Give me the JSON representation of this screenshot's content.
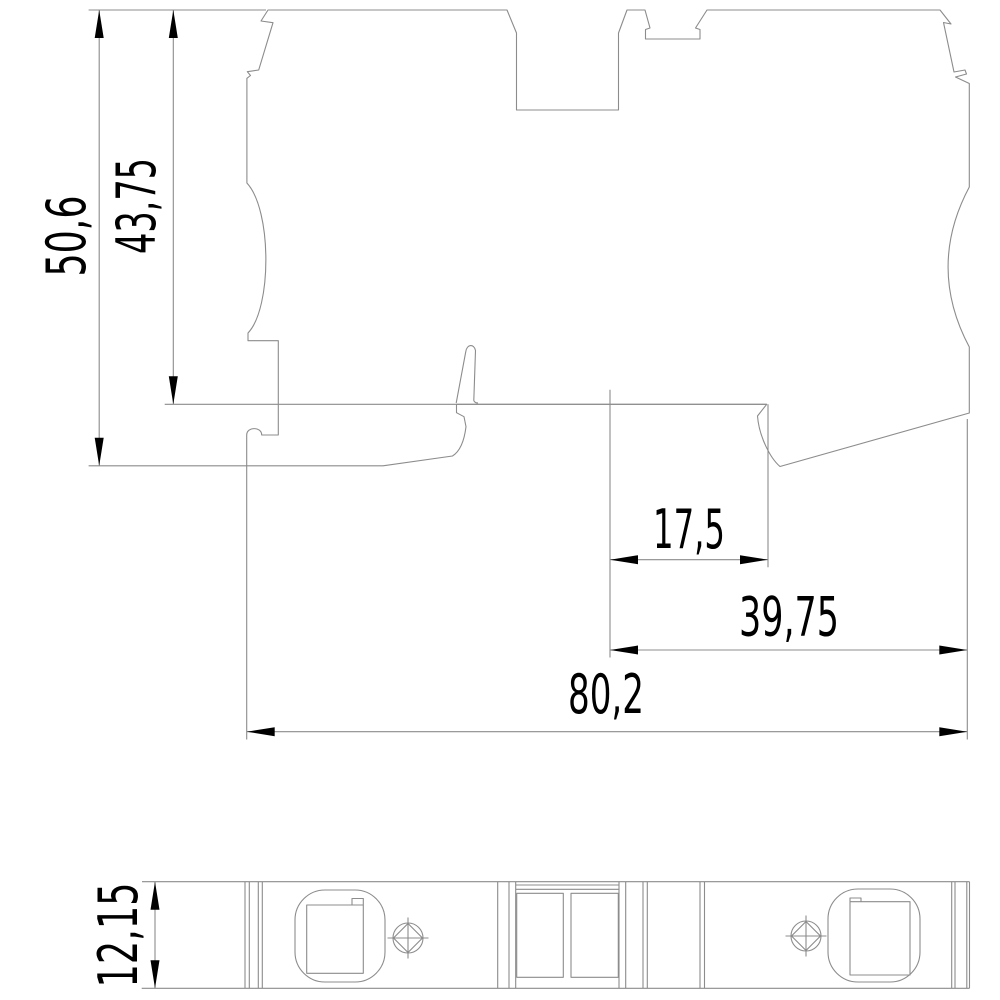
{
  "drawing": {
    "kind": "technical-dimension-drawing",
    "background_color": "#ffffff",
    "line_color": "#8c8c8c",
    "annotation_color": "#000000",
    "dimensions": {
      "overall_height": "50,6",
      "upper_height": "43,75",
      "pitch_offset": "17,5",
      "right_section_width": "39,75",
      "overall_width": "80,2",
      "profile_depth": "12,15"
    }
  }
}
